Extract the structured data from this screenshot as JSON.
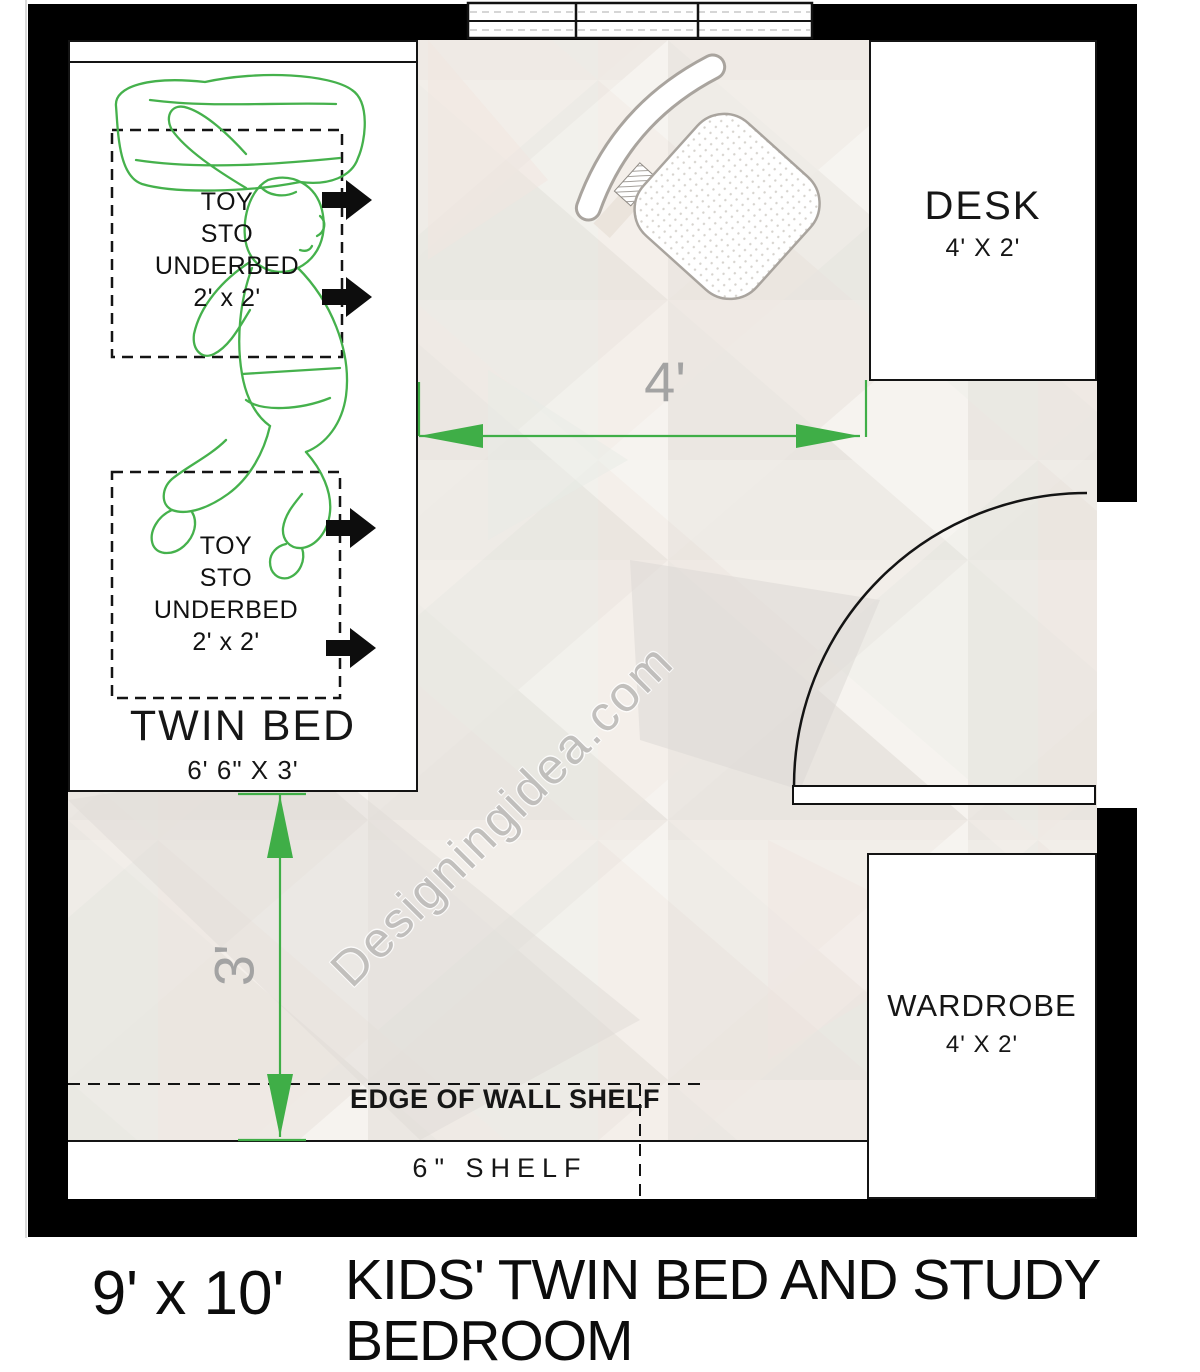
{
  "plan": {
    "watermark": "Designingidea.com",
    "caption": {
      "size": "9' x 10'",
      "title_line1": "KIDS' TWIN BED AND STUDY",
      "title_line2": "BEDROOM"
    },
    "room": {
      "bed": {
        "label": "TWIN BED",
        "size": "6' 6\" X 3'",
        "toy_boxes": [
          {
            "lines": [
              "TOY",
              "STO",
              "UNDERBED",
              "2' x 2'"
            ]
          },
          {
            "lines": [
              "TOY",
              "STO",
              "UNDERBED",
              "2' x 2'"
            ]
          }
        ]
      },
      "desk": {
        "label": "DESK",
        "size": "4' X 2'"
      },
      "wardrobe": {
        "label": "WARDROBE",
        "size": "4' X 2'"
      },
      "shelf": {
        "label": "6\" SHELF",
        "edge_label": "EDGE OF WALL SHELF"
      },
      "dimensions": {
        "horizontal": "4'",
        "vertical": "3'"
      }
    },
    "colors": {
      "wall_black": "#000000",
      "outline_dark": "#141414",
      "dimension_green": "#3fae47",
      "dimension_label_gray": "#a3a3a3",
      "figure_green": "#45b14c",
      "chair_outline": "#a9a49e"
    }
  }
}
